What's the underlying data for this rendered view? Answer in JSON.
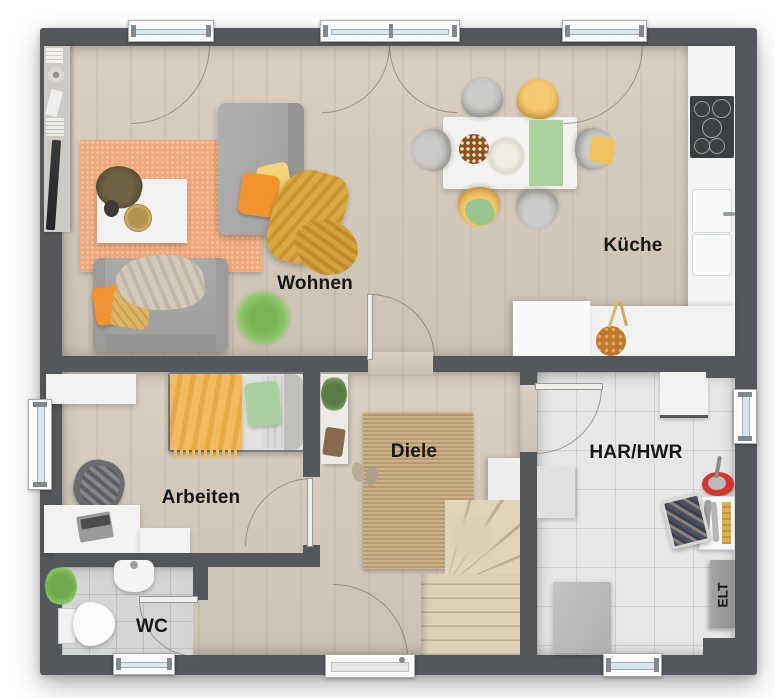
{
  "rooms": [
    {
      "id": "wohnen",
      "label": "Wohnen"
    },
    {
      "id": "kueche",
      "label": "Küche"
    },
    {
      "id": "arbeiten",
      "label": "Arbeiten"
    },
    {
      "id": "diele",
      "label": "Diele"
    },
    {
      "id": "wc",
      "label": "WC"
    },
    {
      "id": "har_hwr",
      "label": "HAR/HWR"
    },
    {
      "id": "elt",
      "label": "ELT"
    }
  ],
  "colors": {
    "wall": "#54575b",
    "wood_floor": "#d6cabb",
    "wc_tile": "#d4d6d5",
    "hwr_tile": "#e6e7e6",
    "living_rug": "#efa97c",
    "jute_rug": "#c2a377",
    "accent_orange": "#f2952f",
    "accent_yellow": "#f3d37e",
    "accent_green": "#a9cf9e",
    "accent_mustard": "#d9a23c",
    "bucket_red": "#d6352f",
    "label_text": "#171717"
  }
}
